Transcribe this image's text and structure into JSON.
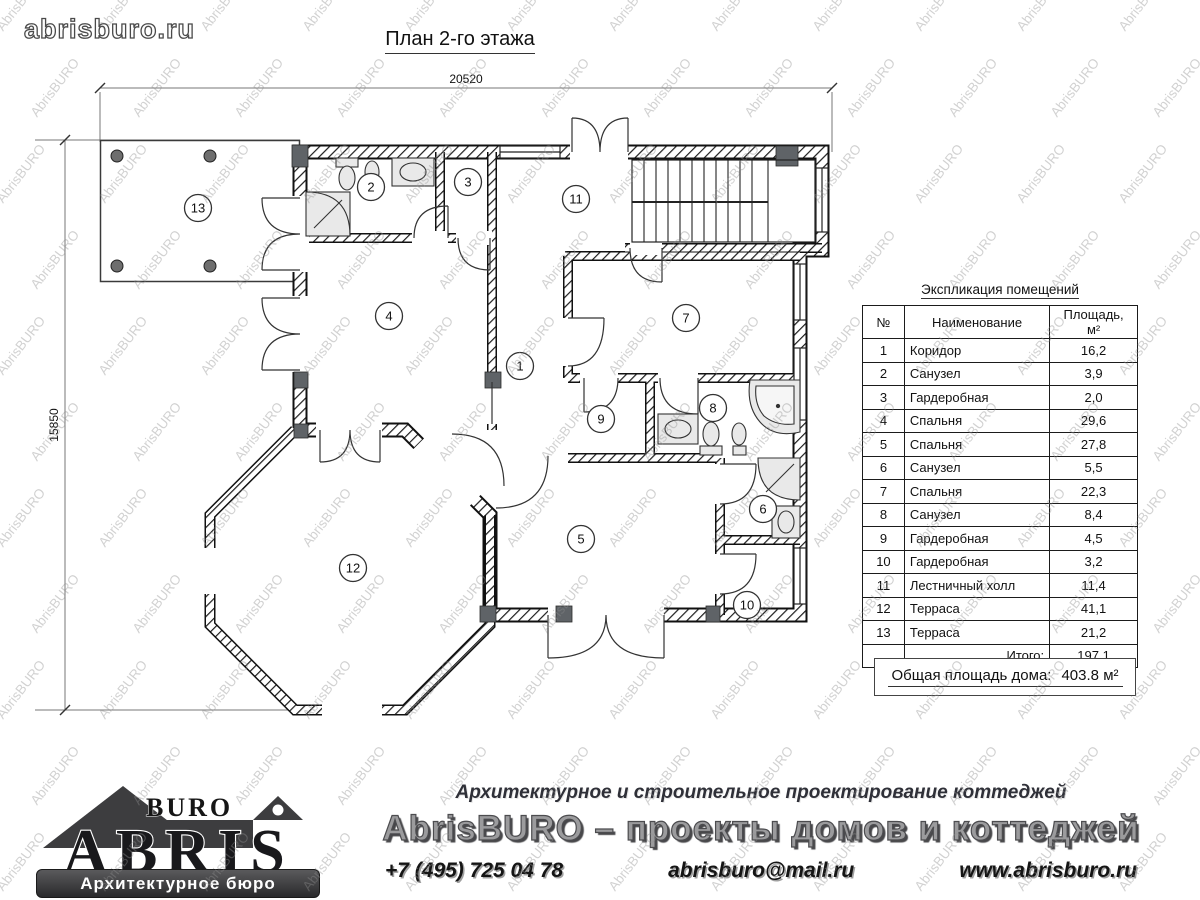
{
  "header": {
    "site": "abrisburo.ru",
    "title": "План 2-го этажа"
  },
  "watermark": {
    "text": "AbrisBURO"
  },
  "plan": {
    "dim_width": "20520",
    "dim_height": "15850",
    "room_numbers": [
      "1",
      "2",
      "3",
      "4",
      "5",
      "6",
      "7",
      "8",
      "9",
      "10",
      "11",
      "12",
      "13"
    ]
  },
  "explication": {
    "title": "Экспликация помещений",
    "columns": [
      "№",
      "Наименование",
      "Площадь, м²"
    ],
    "rows": [
      [
        "1",
        "Коридор",
        "16,2"
      ],
      [
        "2",
        "Санузел",
        "3,9"
      ],
      [
        "3",
        "Гардеробная",
        "2,0"
      ],
      [
        "4",
        "Спальня",
        "29,6"
      ],
      [
        "5",
        "Спальня",
        "27,8"
      ],
      [
        "6",
        "Санузел",
        "5,5"
      ],
      [
        "7",
        "Спальня",
        "22,3"
      ],
      [
        "8",
        "Санузел",
        "8,4"
      ],
      [
        "9",
        "Гардеробная",
        "4,5"
      ],
      [
        "10",
        "Гардеробная",
        "3,2"
      ],
      [
        "11",
        "Лестничный холл",
        "11,4"
      ],
      [
        "12",
        "Терраса",
        "41,1"
      ],
      [
        "13",
        "Терраса",
        "21,2"
      ]
    ],
    "total_label": "Итого:",
    "total_value": "197.1"
  },
  "summary": {
    "label": "Общая площадь дома:",
    "value": "403.8",
    "unit": "м²"
  },
  "footer": {
    "logo_top": "BURO",
    "logo_name": "ABRIS",
    "logo_banner": "Архитектурное бюро",
    "tagline": "Архитектурное и строительное проектирование коттеджей",
    "headline": "AbrisBURO – проекты домов и коттеджей",
    "phone": "+7 (495) 725 04 78",
    "email": "abrisburo@mail.ru",
    "website": "www.abrisburo.ru"
  }
}
